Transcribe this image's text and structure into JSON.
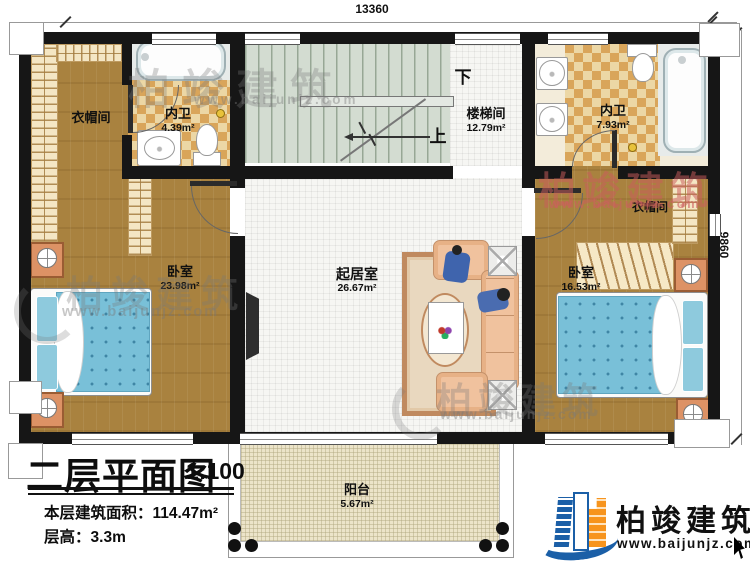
{
  "dimensions": {
    "width_mm": "13360",
    "depth_mm": "9860"
  },
  "rooms": {
    "cloakroom_tl": {
      "name": "衣帽间"
    },
    "bath_left": {
      "name": "内卫",
      "area": "4.39m²"
    },
    "stairwell": {
      "name": "楼梯间",
      "area": "12.79m²",
      "down_label": "下",
      "up_label": "上"
    },
    "bath_right": {
      "name": "内卫",
      "area": "7.93m²"
    },
    "cloakroom_right": {
      "name": "衣帽间"
    },
    "bedroom_left": {
      "name": "卧室",
      "area": "23.98m²"
    },
    "living_room": {
      "name": "起居室",
      "area": "26.67m²"
    },
    "bedroom_right": {
      "name": "卧室",
      "area": "16.53m²"
    },
    "balcony": {
      "name": "阳台",
      "area": "5.67m²"
    }
  },
  "title_block": {
    "title": "二层平面图",
    "scale": "1:100",
    "area_label": "本层建筑面积：",
    "area_value": "114.47m²",
    "height_label": "层高：",
    "height_value": "3.3m"
  },
  "branding": {
    "watermark_brand": "柏竣建筑",
    "watermark_url": "www.baijunjz.com",
    "logo_brand": "柏竣建筑",
    "logo_url": "www.baijunjz.com"
  },
  "colors": {
    "wall": "#161616",
    "logo_blue": "#1b5fa7",
    "logo_orange": "#f7941d",
    "bed_blue": "#79c0d8",
    "watermark_red": "rgba(201,92,92,0.52)"
  }
}
